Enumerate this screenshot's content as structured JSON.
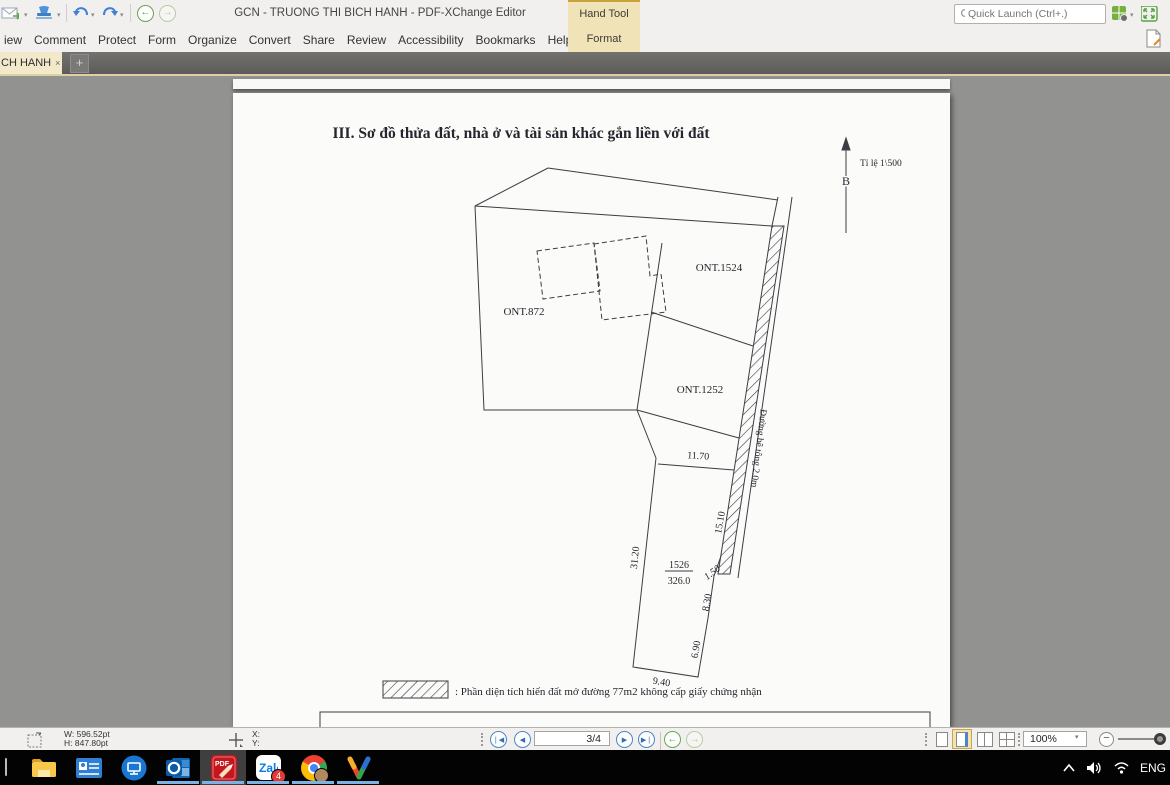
{
  "titlebar": {
    "app_title": "GCN - TRUONG THI BICH HANH - PDF-XChange Editor",
    "quick_launch_placeholder": "Quick Launch (Ctrl+.)",
    "hand_tool_label": "Hand Tool",
    "format_label": "Format"
  },
  "menubar": {
    "items": [
      "iew",
      "Comment",
      "Protect",
      "Form",
      "Organize",
      "Convert",
      "Share",
      "Review",
      "Accessibility",
      "Bookmarks",
      "Help"
    ]
  },
  "tabbar": {
    "active_tab_label": "CH HANH",
    "close_glyph": "×",
    "new_tab_glyph": "+"
  },
  "document": {
    "section_title": "III. Sơ đồ thửa đất, nhà ở và tài sản khác gắn liền với đất",
    "scale_label": "Tỉ lệ 1\\500",
    "north_label": "B",
    "parcel_labels": {
      "ont1524": "ONT.1524",
      "ont872": "ONT.872",
      "ont1252": "ONT.1252"
    },
    "parcel_number": "1526",
    "parcel_area": "326.0",
    "road_label": "Đường bê tông 2.0m",
    "dimensions": {
      "top": "11.70",
      "left": "31.20",
      "road": "15.10",
      "jog": "1.50",
      "right_upper": "8.30",
      "right_lower": "6.90",
      "bottom": "9.40"
    },
    "legend_text": ": Phần diện tích hiến đất mở đường 77m2 không cấp giấy chứng nhận"
  },
  "statusbar": {
    "width_label": "W: 596.52pt",
    "height_label": "H: 847.80pt",
    "x_label": "X:",
    "y_label": "Y:",
    "page_display": "3/4",
    "zoom_value": "100%"
  },
  "taskbar": {
    "language": "ENG",
    "zalo_badge": "4"
  },
  "colors": {
    "accent_tan": "#f0e3b8",
    "running_indicator": "#79b3e6",
    "pdf_red": "#c4161c"
  }
}
